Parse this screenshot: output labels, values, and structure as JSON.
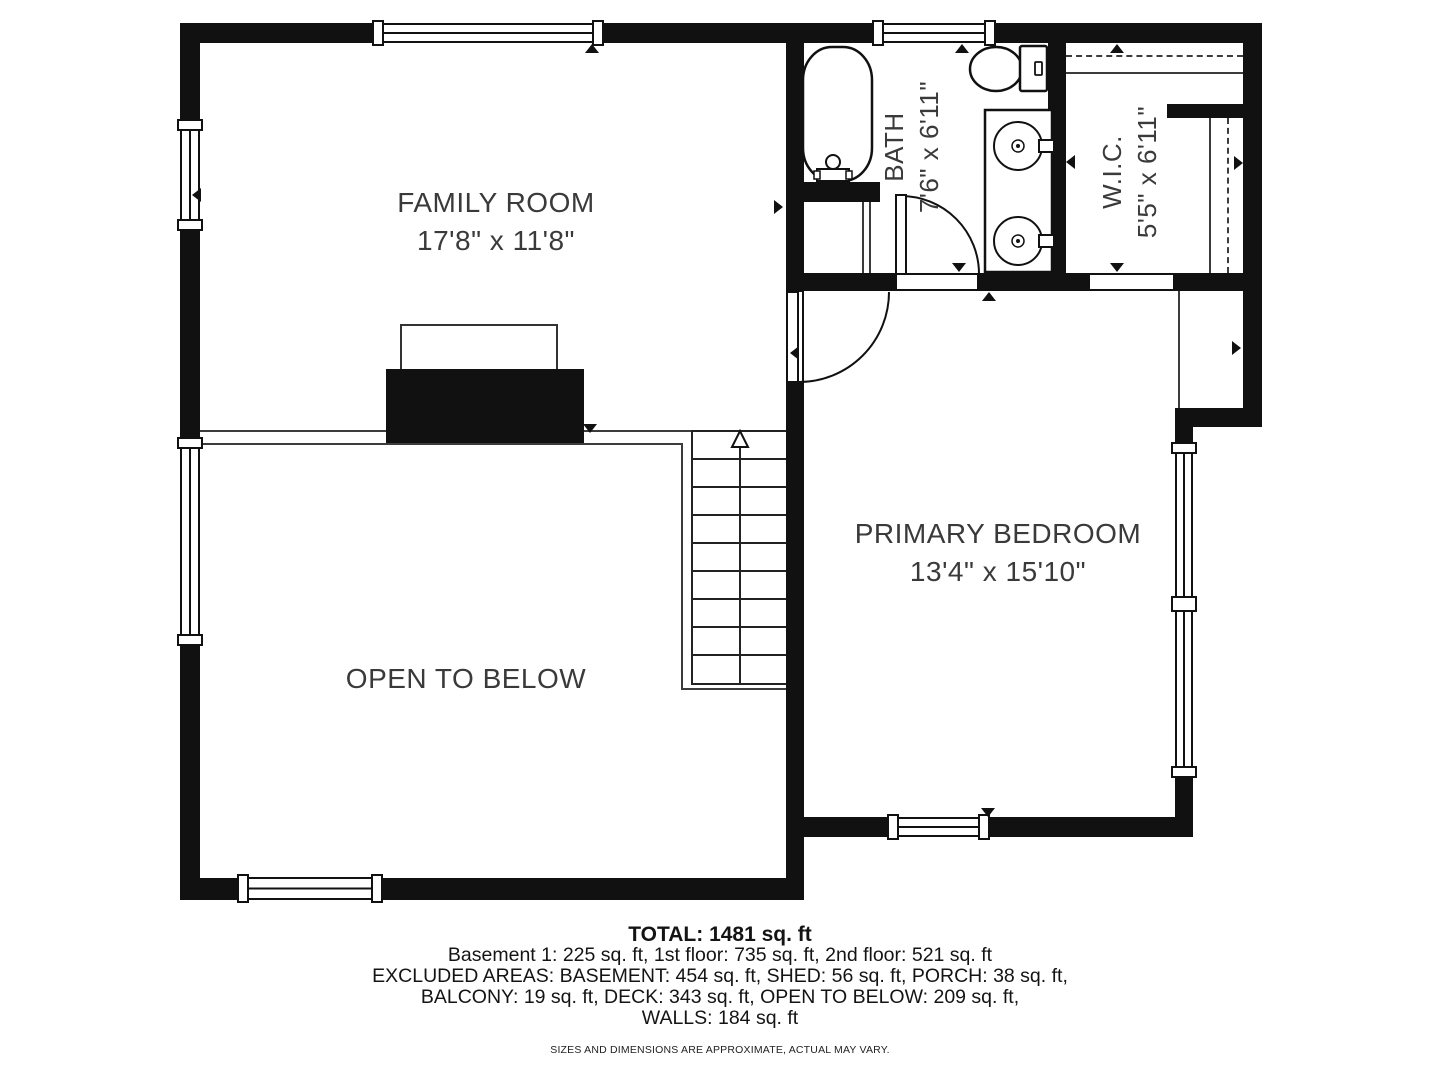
{
  "rooms": {
    "family_room": {
      "name": "FAMILY ROOM",
      "dims": "17'8\" x 11'8\""
    },
    "bath": {
      "name": "BATH",
      "dims": "7'6\" x 6'11\""
    },
    "wic": {
      "name": "W.I.C.",
      "dims": "5'5\" x 6'11\""
    },
    "primary_bedroom": {
      "name": "PRIMARY BEDROOM",
      "dims": "13'4\" x 15'10\""
    },
    "open_to_below": {
      "name": "OPEN TO BELOW"
    }
  },
  "summary": {
    "total": "TOTAL: 1481 sq. ft",
    "line1": "Basement 1: 225 sq. ft, 1st floor: 735 sq. ft, 2nd floor: 521 sq. ft",
    "line2": "EXCLUDED AREAS: BASEMENT: 454 sq. ft, SHED: 56 sq. ft, PORCH: 38 sq. ft,",
    "line3": "BALCONY: 19 sq. ft, DECK: 343 sq. ft, OPEN TO BELOW: 209 sq. ft,",
    "line4": "WALLS: 184 sq. ft",
    "disclaimer": "SIZES AND DIMENSIONS ARE APPROXIMATE, ACTUAL MAY VARY."
  },
  "colors": {
    "wall": "#111111",
    "thin_line": "#3c3c3c",
    "label": "#3a3a3a",
    "background": "#ffffff"
  }
}
